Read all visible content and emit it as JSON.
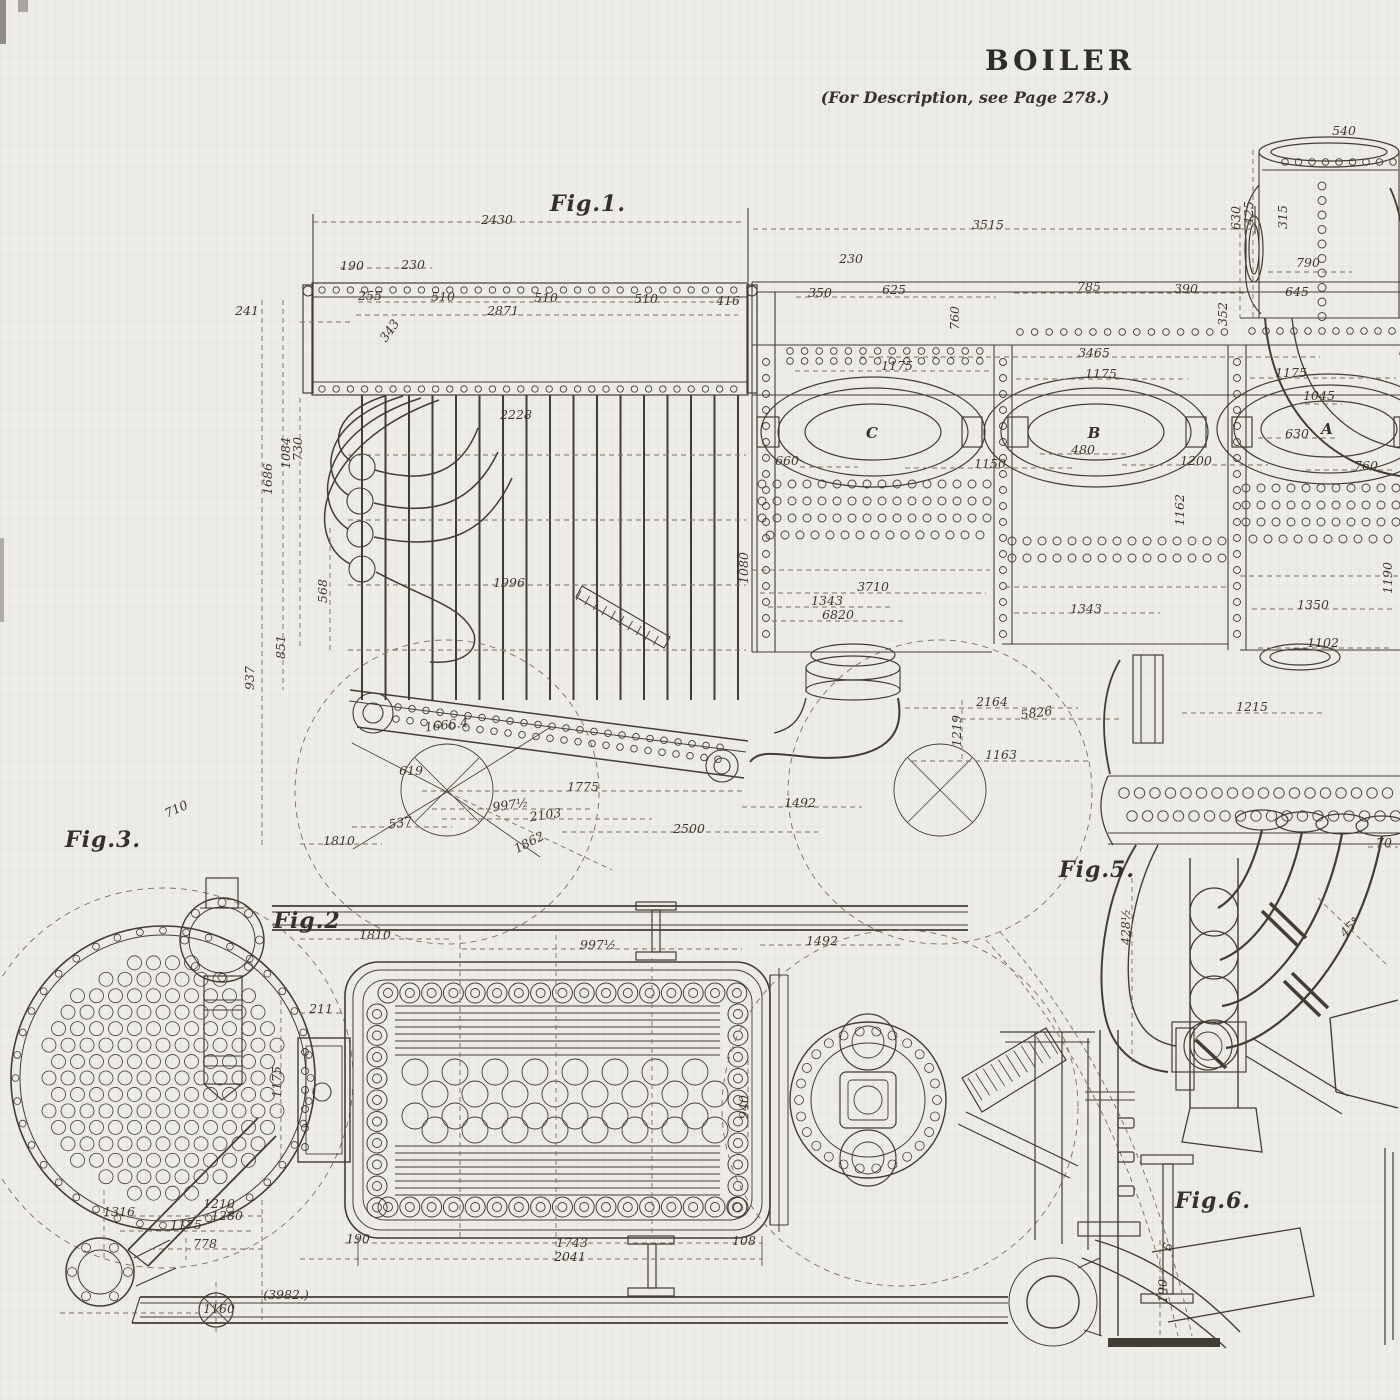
{
  "header": {
    "title": "BOILER",
    "subtitle": "(For Description, see Page 278.)"
  },
  "colors": {
    "paper": "#eeece6",
    "ink": "#403d35",
    "dim_line": "#767060"
  },
  "figures": [
    {
      "label": "Fig.1.",
      "x": 588,
      "y": 211
    },
    {
      "label": "Fig.2",
      "x": 307,
      "y": 928
    },
    {
      "label": "Fig.3.",
      "x": 103,
      "y": 847
    },
    {
      "label": "Fig.5.",
      "x": 1097,
      "y": 877
    },
    {
      "label": "Fig.6.",
      "x": 1213,
      "y": 1208
    }
  ],
  "part_labels": [
    {
      "text": "C",
      "x": 872,
      "y": 438
    },
    {
      "text": "B",
      "x": 1094,
      "y": 438
    },
    {
      "text": "A",
      "x": 1327,
      "y": 434
    }
  ],
  "dimensions": [
    {
      "text": "2430",
      "x": 497,
      "y": 224
    },
    {
      "text": "3515",
      "x": 988,
      "y": 229
    },
    {
      "text": "230",
      "x": 851,
      "y": 263
    },
    {
      "text": "540",
      "x": 1344,
      "y": 135
    },
    {
      "text": "190",
      "x": 352,
      "y": 270
    },
    {
      "text": "230",
      "x": 413,
      "y": 269
    },
    {
      "text": "255",
      "x": 370,
      "y": 300
    },
    {
      "text": "510",
      "x": 443,
      "y": 301
    },
    {
      "text": "510",
      "x": 546,
      "y": 302
    },
    {
      "text": "510",
      "x": 646,
      "y": 303
    },
    {
      "text": "416",
      "x": 728,
      "y": 305
    },
    {
      "text": "2871",
      "x": 503,
      "y": 315
    },
    {
      "text": "343",
      "x": 393,
      "y": 333,
      "rot": -55
    },
    {
      "text": "241",
      "x": 247,
      "y": 315
    },
    {
      "text": "350",
      "x": 820,
      "y": 297
    },
    {
      "text": "625",
      "x": 894,
      "y": 294
    },
    {
      "text": "760",
      "x": 959,
      "y": 318,
      "rot": -90
    },
    {
      "text": "785",
      "x": 1089,
      "y": 291
    },
    {
      "text": "390",
      "x": 1186,
      "y": 293
    },
    {
      "text": "645",
      "x": 1297,
      "y": 296
    },
    {
      "text": "352",
      "x": 1227,
      "y": 314,
      "rot": -90
    },
    {
      "text": "630",
      "x": 1240,
      "y": 218,
      "rot": -90
    },
    {
      "text": "425",
      "x": 1253,
      "y": 213,
      "rot": -90
    },
    {
      "text": "315",
      "x": 1287,
      "y": 217,
      "rot": -90
    },
    {
      "text": "790",
      "x": 1308,
      "y": 267
    },
    {
      "text": "3465",
      "x": 1094,
      "y": 357
    },
    {
      "text": "1175",
      "x": 897,
      "y": 370
    },
    {
      "text": "1175",
      "x": 1101,
      "y": 378
    },
    {
      "text": "1175",
      "x": 1291,
      "y": 377
    },
    {
      "text": "1045",
      "x": 1319,
      "y": 400
    },
    {
      "text": "480",
      "x": 1083,
      "y": 454
    },
    {
      "text": "630",
      "x": 1297,
      "y": 438
    },
    {
      "text": "660",
      "x": 787,
      "y": 465
    },
    {
      "text": "1150",
      "x": 990,
      "y": 468
    },
    {
      "text": "1200",
      "x": 1196,
      "y": 465
    },
    {
      "text": "760",
      "x": 1366,
      "y": 470
    },
    {
      "text": "1162",
      "x": 1184,
      "y": 510,
      "rot": -90
    },
    {
      "text": "1686",
      "x": 272,
      "y": 479,
      "rot": -90
    },
    {
      "text": "1084",
      "x": 290,
      "y": 453,
      "rot": -90
    },
    {
      "text": "730",
      "x": 302,
      "y": 449,
      "rot": -90
    },
    {
      "text": "568",
      "x": 327,
      "y": 591,
      "rot": -90
    },
    {
      "text": "851",
      "x": 285,
      "y": 647,
      "rot": -90
    },
    {
      "text": "937",
      "x": 254,
      "y": 678,
      "rot": -90
    },
    {
      "text": "2228",
      "x": 516,
      "y": 419
    },
    {
      "text": "1996",
      "x": 509,
      "y": 587
    },
    {
      "text": "1080",
      "x": 748,
      "y": 568,
      "rot": -90
    },
    {
      "text": "3710",
      "x": 873,
      "y": 591
    },
    {
      "text": "1343",
      "x": 827,
      "y": 605
    },
    {
      "text": "6820",
      "x": 838,
      "y": 619
    },
    {
      "text": "1343",
      "x": 1086,
      "y": 613
    },
    {
      "text": "1350",
      "x": 1313,
      "y": 609
    },
    {
      "text": "1102",
      "x": 1323,
      "y": 647
    },
    {
      "text": "1190",
      "x": 1392,
      "y": 578,
      "rot": -90
    },
    {
      "text": "2164",
      "x": 992,
      "y": 706
    },
    {
      "text": "5826",
      "x": 1037,
      "y": 717,
      "rot": -8
    },
    {
      "text": "1219",
      "x": 961,
      "y": 731,
      "rot": -90
    },
    {
      "text": "1163",
      "x": 1001,
      "y": 759
    },
    {
      "text": "1215",
      "x": 1252,
      "y": 711
    },
    {
      "text": "1666.4",
      "x": 447,
      "y": 729,
      "rot": -7
    },
    {
      "text": "619",
      "x": 411,
      "y": 775
    },
    {
      "text": "1775",
      "x": 583,
      "y": 791
    },
    {
      "text": "997½",
      "x": 511,
      "y": 809,
      "rot": -8
    },
    {
      "text": "2103",
      "x": 546,
      "y": 819,
      "rot": -8
    },
    {
      "text": "537",
      "x": 401,
      "y": 827,
      "rot": -8
    },
    {
      "text": "1810",
      "x": 339,
      "y": 845
    },
    {
      "text": "1862",
      "x": 531,
      "y": 846,
      "rot": -27
    },
    {
      "text": "2500",
      "x": 689,
      "y": 833
    },
    {
      "text": "1492",
      "x": 800,
      "y": 807
    },
    {
      "text": "710",
      "x": 178,
      "y": 813,
      "rot": -25
    },
    {
      "text": "1316",
      "x": 119,
      "y": 1216
    },
    {
      "text": "1175",
      "x": 186,
      "y": 1229
    },
    {
      "text": "1210",
      "x": 219,
      "y": 1208
    },
    {
      "text": "1280",
      "x": 227,
      "y": 1220
    },
    {
      "text": "778",
      "x": 205,
      "y": 1248
    },
    {
      "text": "1160",
      "x": 219,
      "y": 1313
    },
    {
      "text": "1810",
      "x": 375,
      "y": 939
    },
    {
      "text": "997½",
      "x": 598,
      "y": 949
    },
    {
      "text": "1492",
      "x": 822,
      "y": 945
    },
    {
      "text": "211",
      "x": 321,
      "y": 1013
    },
    {
      "text": "1175",
      "x": 281,
      "y": 1082,
      "rot": -90
    },
    {
      "text": "940",
      "x": 748,
      "y": 1107,
      "rot": -90
    },
    {
      "text": "190",
      "x": 358,
      "y": 1243
    },
    {
      "text": "1743",
      "x": 572,
      "y": 1247
    },
    {
      "text": "2041",
      "x": 570,
      "y": 1261
    },
    {
      "text": "108",
      "x": 744,
      "y": 1245
    },
    {
      "text": "(3982.)",
      "x": 286,
      "y": 1299
    },
    {
      "text": "428½",
      "x": 1130,
      "y": 927,
      "rot": -90
    },
    {
      "text": "70",
      "x": 1384,
      "y": 847
    },
    {
      "text": "45°",
      "x": 1353,
      "y": 930,
      "rot": -45
    },
    {
      "text": "6",
      "x": 1172,
      "y": 1248,
      "rot": -75
    },
    {
      "text": "190",
      "x": 1167,
      "y": 1291,
      "rot": -90
    }
  ]
}
